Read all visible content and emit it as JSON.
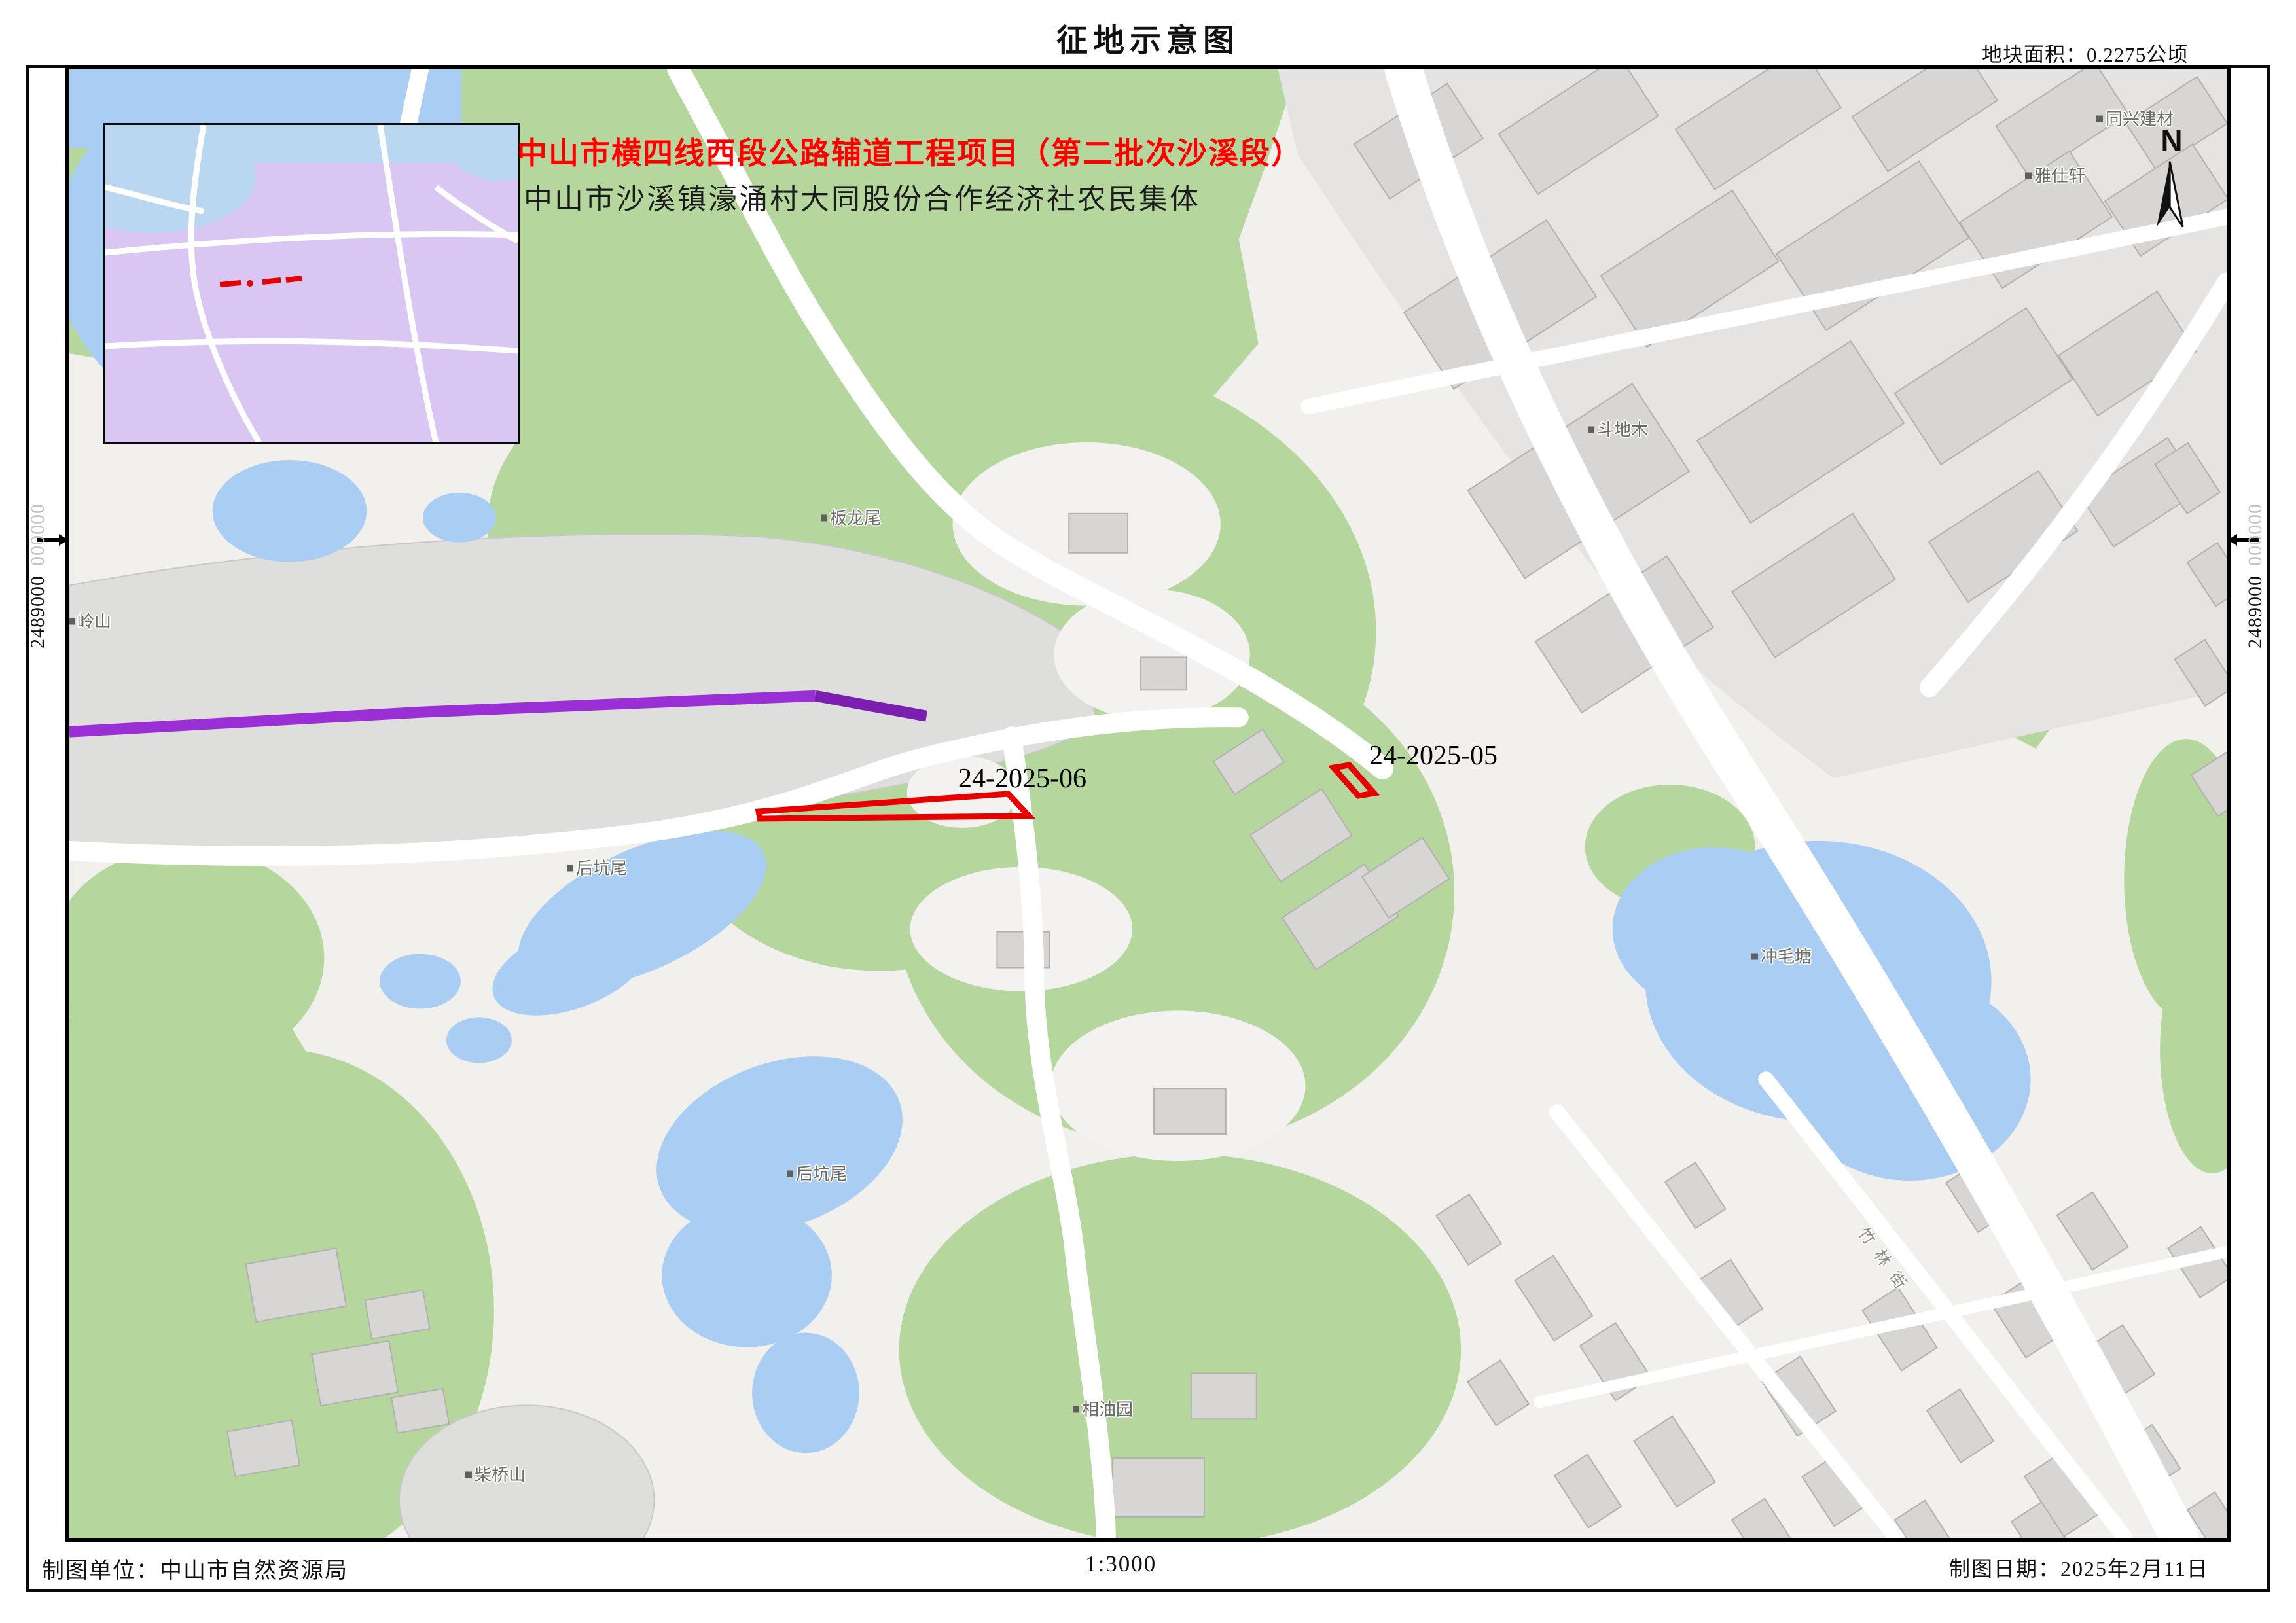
{
  "header": {
    "title": "征地示意图",
    "area_note": "地块面积：0.2275公顷"
  },
  "map_overlay": {
    "project_title": "中山市横四线西段公路辅道工程项目（第二批次沙溪段）",
    "owner": "中山市沙溪镇濠涌村大同股份合作经济社农民集体"
  },
  "parcels": [
    {
      "id": "24-2025-06"
    },
    {
      "id": "24-2025-05"
    }
  ],
  "north_label": "N",
  "grid": {
    "left": {
      "major": "2489000",
      "minor": "000000"
    },
    "right": {
      "major": "2489000",
      "minor": "000000"
    }
  },
  "place_labels": [
    {
      "text": "板龙尾"
    },
    {
      "text": "斗地木"
    },
    {
      "text": "同兴建材"
    },
    {
      "text": "雅仕轩"
    },
    {
      "text": "冲毛塘"
    },
    {
      "text": "后坑尾"
    },
    {
      "text": "后坑尾"
    },
    {
      "text": "柴桥山"
    },
    {
      "text": "相油园"
    },
    {
      "text": "岭山"
    }
  ],
  "road_labels": [
    {
      "text": "竹林街"
    }
  ],
  "footer": {
    "agency": "制图单位：中山市自然资源局",
    "scale": "1:3000",
    "date": "制图日期：2025年2月11日"
  },
  "colors": {
    "parcel_outline": "#e60000",
    "project_title_red": "#ff0000",
    "construction_line_purple": "#9b2fd6",
    "vegetation_green": "#b5d79e",
    "water_blue": "#aacdf3",
    "inset_background": "#d9c6f2",
    "building_gray": "#d7d6d4"
  }
}
